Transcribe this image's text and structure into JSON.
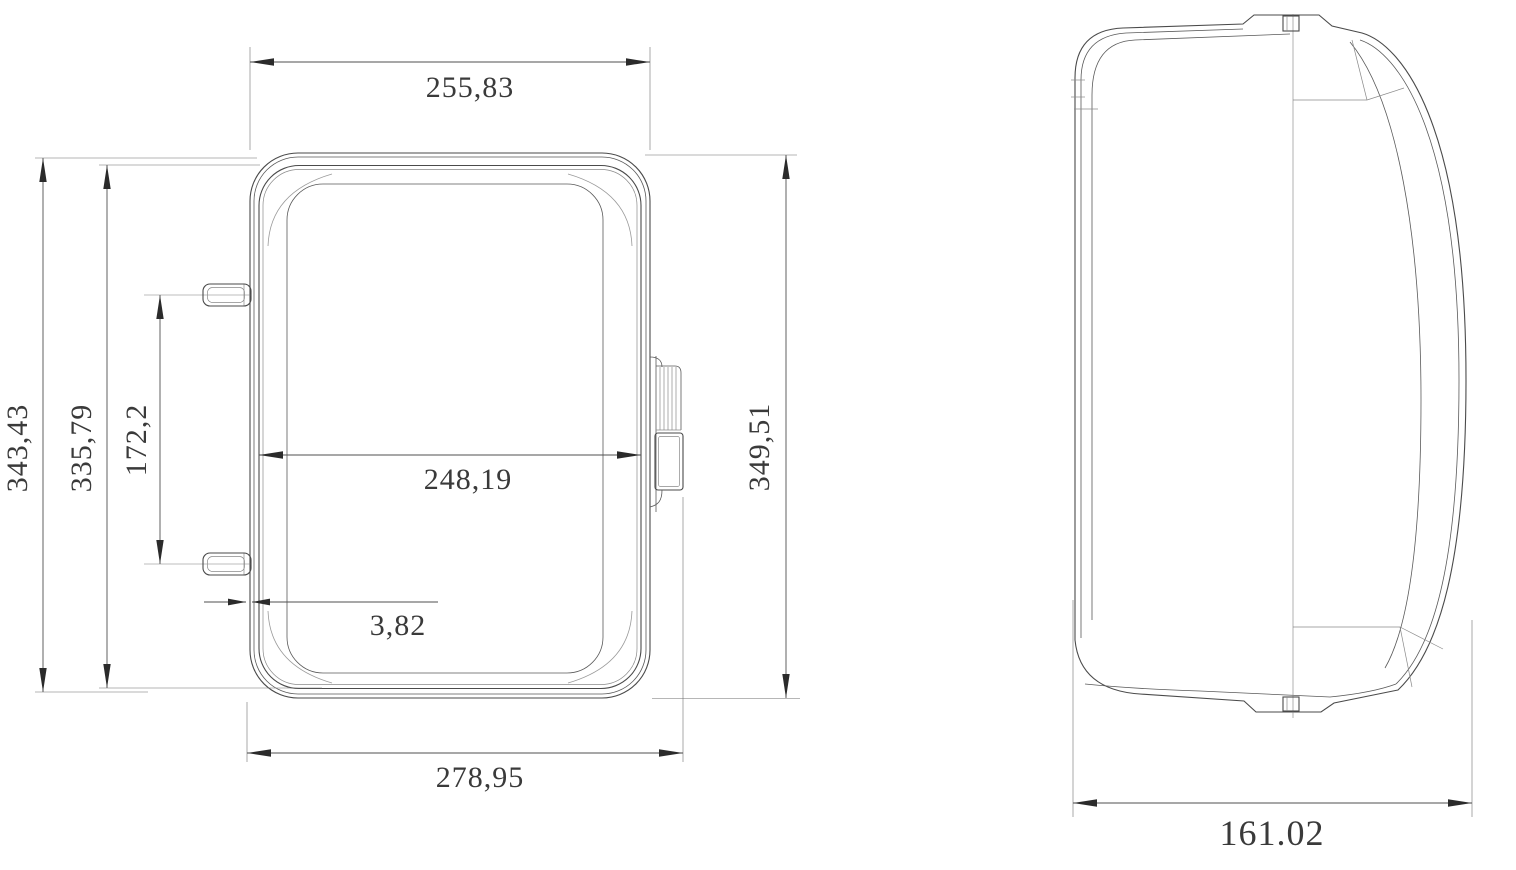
{
  "drawing": {
    "type": "technical-dimension-drawing",
    "views": {
      "front": "front-view",
      "side": "side-view"
    }
  },
  "dims": {
    "front_top_width": "255,83",
    "front_overall_height": "343,43",
    "front_inner_height": "335,79",
    "front_pin_spacing": "172,2",
    "front_inner_width": "248,19",
    "front_wall_thickness": "3,82",
    "front_bottom_width": "278,95",
    "front_right_height": "349,51",
    "side_depth": "161.02"
  },
  "colors": {
    "background": "#ffffff",
    "body_line": "#4a4a4a",
    "dimension_line": "#4f4f4f",
    "arrow": "#2b2b2b",
    "text": "#3a3a3a"
  }
}
